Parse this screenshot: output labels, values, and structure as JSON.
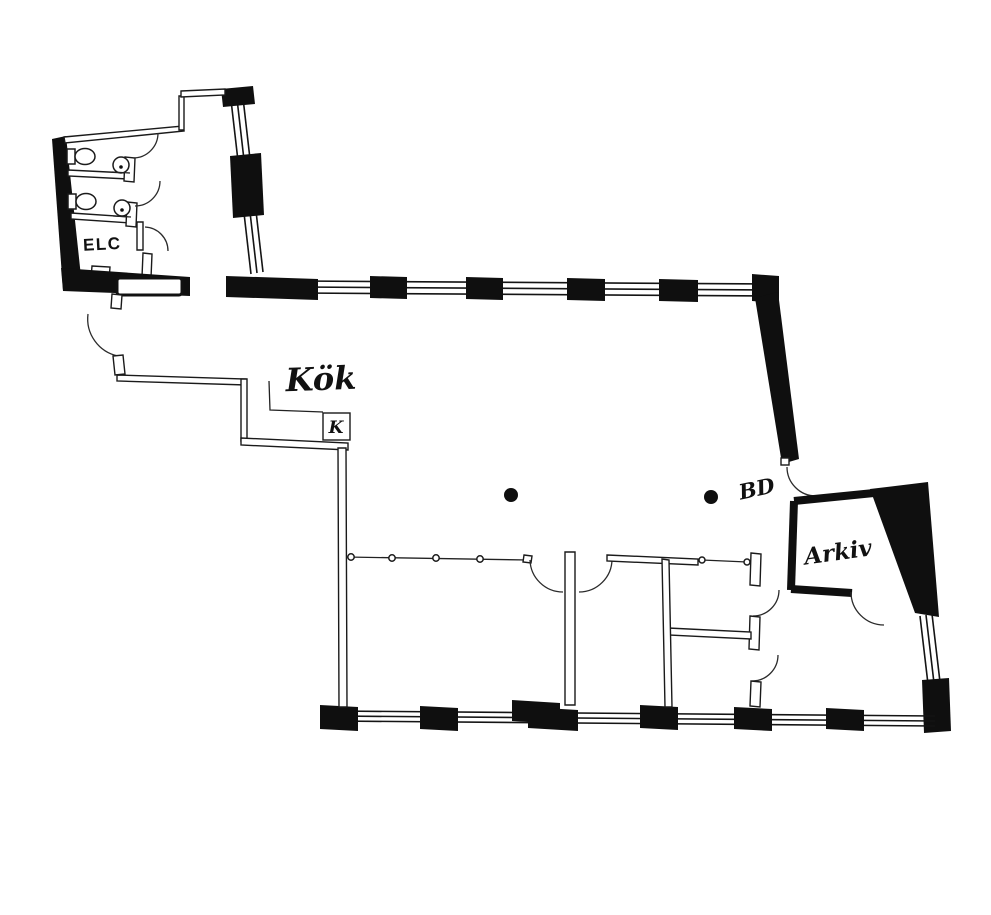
{
  "document": {
    "type": "architectural floor plan",
    "background": "#ffffff",
    "wall_color": "#0f0f0f"
  },
  "labels": {
    "elc": "ELC",
    "kitchen": "Kök",
    "fridge": "K",
    "bd": "BD",
    "archive": "Arkiv"
  },
  "fixtures": {
    "toilets": 2,
    "sinks": 2,
    "columns": 2,
    "window_bands": 4
  }
}
